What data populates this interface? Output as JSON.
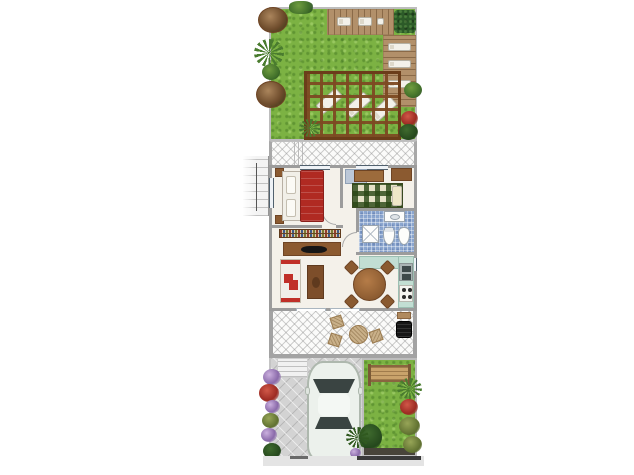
{
  "meta": {
    "kind": "residential floor plan, top view, no text labels",
    "canvas": {
      "width": 634,
      "height": 475
    }
  },
  "colors": {
    "lawn": "#7cb243",
    "wall": "#9c9c9c",
    "floor": "#f4f1ea",
    "deck": "#b2906a",
    "hedge": "#2c5a28",
    "pergola_dark": "#6b3d1a",
    "bathfloor": "#8ba6cf",
    "counter": "#c2ded3",
    "bedred": "#b02a22",
    "sofared": "#c03028",
    "paver": "#d3d3d3",
    "car": "#ecf1ec"
  },
  "scene": {
    "back_garden": {
      "items": [
        "lawn",
        "top-wood-deck",
        "two-white-sun-loungers",
        "corner-hedge",
        "right-wood-deck",
        "two-deck-loungers",
        "timber-pergola",
        "three-pergola-loungers",
        "left-shrub-row",
        "grass-tufts",
        "right-edge-plants"
      ]
    },
    "upper_terrace": {
      "items": [
        "hatched-paving",
        "side-walls"
      ]
    },
    "house": {
      "bedroom": {
        "items": [
          "double-bed-red-duvet",
          "two-pillows",
          "two-nightstands",
          "window-top",
          "window-left"
        ]
      },
      "hallway": {
        "items": [
          "built-in-closet",
          "door-arcs"
        ]
      },
      "study": {
        "items": [
          "desk",
          "cabinet",
          "green-plaid-daybed",
          "cream-pillow",
          "window-top"
        ]
      },
      "bathroom": {
        "items": [
          "blue-mosaic-floor",
          "shower-stall",
          "toilet",
          "bidet",
          "washbasin"
        ]
      },
      "kitchen": {
        "items": [
          "teal-counter-l-shape",
          "double-sink",
          "four-burner-cooktop",
          "window-right"
        ]
      },
      "living_dining": {
        "items": [
          "bookshelf",
          "sideboard-with-tv",
          "white-sofa-red-cushions",
          "coffee-table",
          "round-dining-table",
          "four-chairs",
          "sliding-doors-to-patio"
        ]
      }
    },
    "patio": {
      "items": [
        "hatched-paving",
        "wicker-round-table",
        "three-wicker-chairs",
        "barbecue-grill",
        "grill-side-table"
      ]
    },
    "front_yard": {
      "items": [
        "paver-driveway",
        "entrance-steps",
        "white-car-top-view",
        "front-lawn",
        "wooden-bench",
        "boundary-dark-strip",
        "flower-border-left",
        "shrubs-right",
        "sidewalk",
        "kerb-marks"
      ]
    },
    "neighbour": {
      "items": [
        "adjacent-staircase"
      ]
    }
  }
}
